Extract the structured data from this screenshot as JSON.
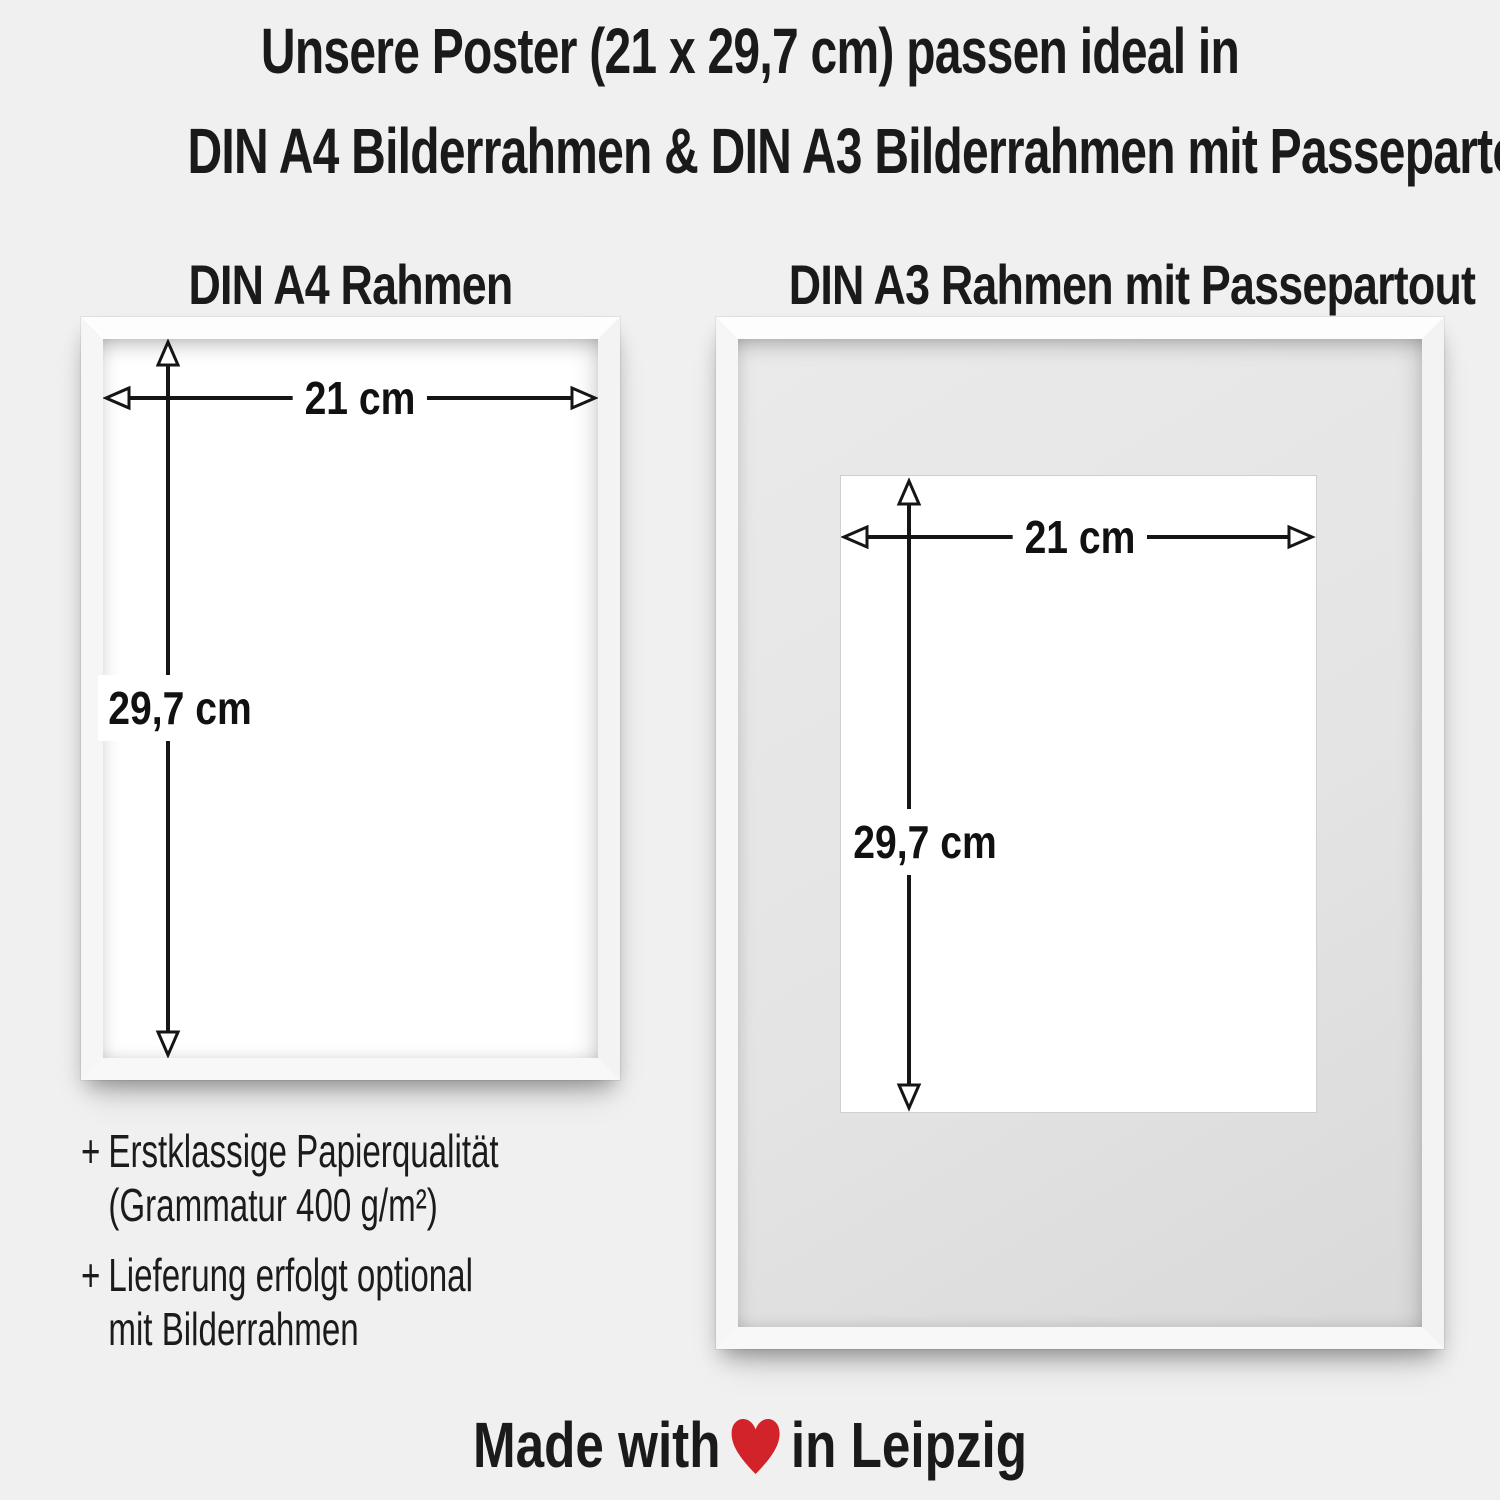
{
  "title": {
    "line1": "Unsere Poster (21 x 29,7 cm) passen ideal in",
    "line2": "DIN A4 Bilderrahmen & DIN A3 Bilderrahmen mit Passepartout"
  },
  "frames": {
    "a4": {
      "heading": "DIN A4 Rahmen",
      "width_label": "21 cm",
      "height_label": "29,7 cm"
    },
    "a3": {
      "heading": "DIN A3 Rahmen mit Passepartout",
      "width_label": "21 cm",
      "height_label": "29,7 cm"
    }
  },
  "features": [
    {
      "bullet": "+",
      "lines": [
        "Erstklassige Papierqualität",
        "(Grammatur 400 g/m²)"
      ]
    },
    {
      "bullet": "+",
      "lines": [
        "Lieferung erfolgt optional",
        "mit Bilderrahmen"
      ]
    }
  ],
  "footer": {
    "prefix": "Made with",
    "suffix": "in Leipzig",
    "heart_color": "#d2222a"
  },
  "colors": {
    "background": "#f0f0f0",
    "text": "#1a1a1a",
    "arrow": "#151515",
    "frame_white": "#ffffff",
    "passepartout": "#e4e4e4",
    "poster": "#ffffff"
  }
}
